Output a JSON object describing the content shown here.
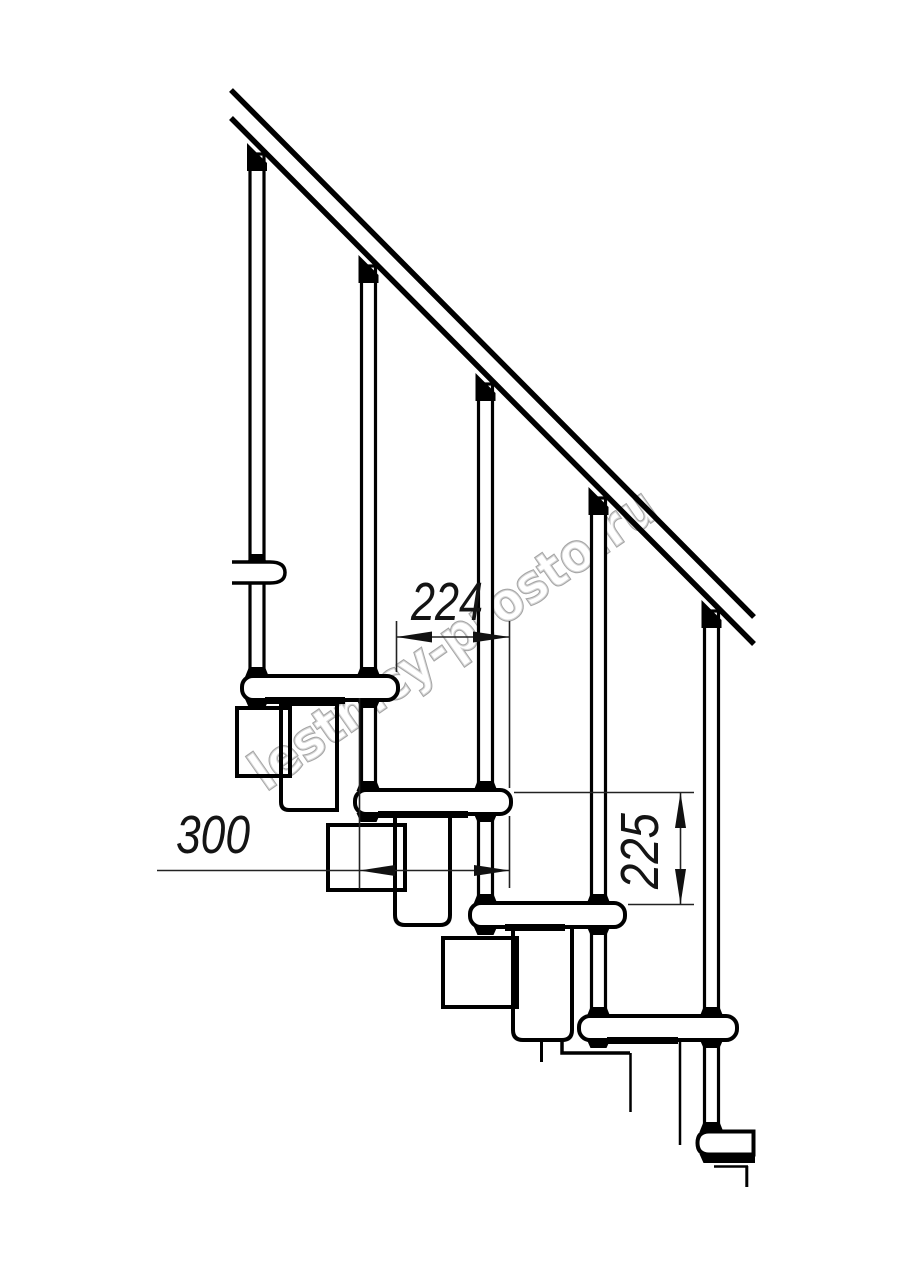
{
  "drawing": {
    "subject": "modular staircase side elevation",
    "background_color": "#ffffff",
    "ink_color": "#000000",
    "thin_line_color": "#222222"
  },
  "dimensions": {
    "going": {
      "value": "224",
      "orientation": "horizontal"
    },
    "tread_depth": {
      "value": "300",
      "orientation": "horizontal"
    },
    "rise": {
      "value": "225",
      "orientation": "vertical"
    }
  },
  "watermark": {
    "text": "lestnicy-prosto.ru",
    "outline_color": "#a5a5a5"
  }
}
